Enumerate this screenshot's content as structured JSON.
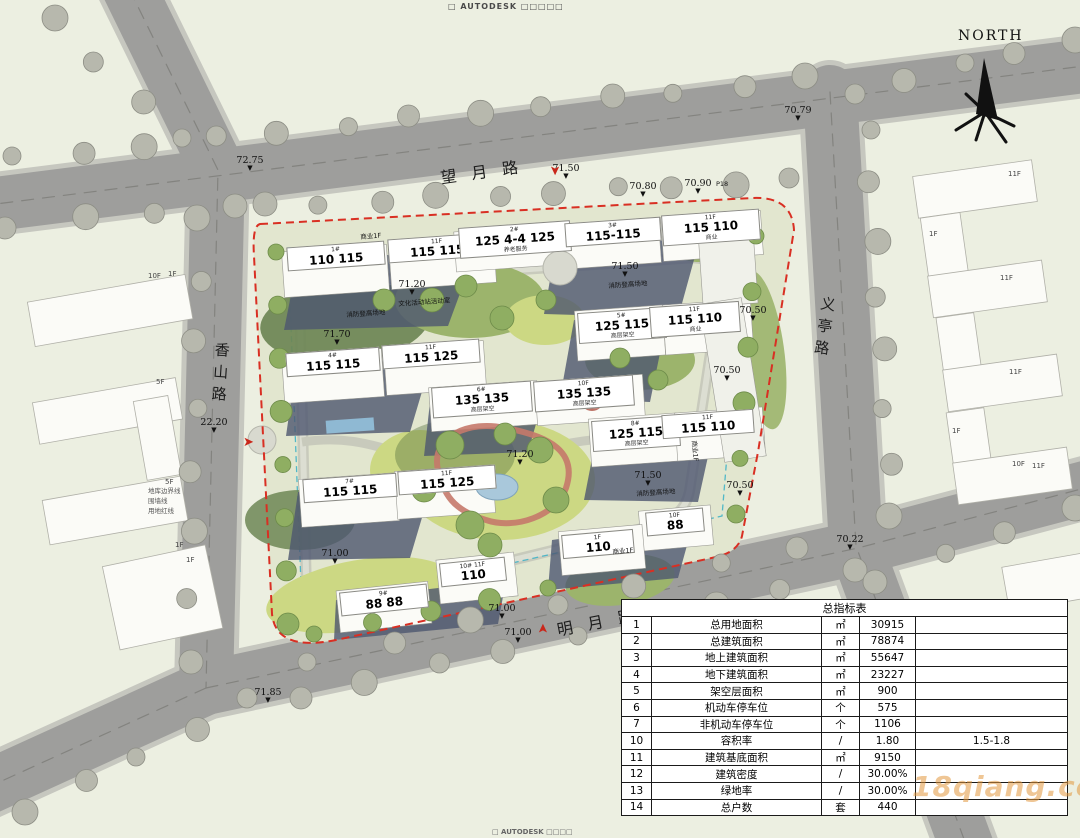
{
  "meta": {
    "autodesk_top": "□ AUTODESK □□□□□",
    "autodesk_bottom": "□ AUTODESK □□□□",
    "north": "NORTH",
    "watermark": "18qiang.com"
  },
  "roads": {
    "top": "望月路",
    "bottom": "明月路",
    "left": "香山路",
    "right": "义亭路"
  },
  "legend": [
    "地库边界线",
    "围墙线",
    "用地红线"
  ],
  "elevations": [
    {
      "t": "72.75",
      "x": 250,
      "y": 156
    },
    {
      "t": "70.79",
      "x": 798,
      "y": 106
    },
    {
      "t": "71.50",
      "x": 566,
      "y": 164
    },
    {
      "t": "70.80",
      "x": 643,
      "y": 182
    },
    {
      "t": "70.90",
      "x": 698,
      "y": 179
    },
    {
      "t": "22.20",
      "x": 214,
      "y": 418
    },
    {
      "t": "71.20",
      "x": 412,
      "y": 280
    },
    {
      "t": "71.70",
      "x": 337,
      "y": 330
    },
    {
      "t": "71.50",
      "x": 625,
      "y": 262
    },
    {
      "t": "70.50",
      "x": 753,
      "y": 306
    },
    {
      "t": "70.50",
      "x": 727,
      "y": 366
    },
    {
      "t": "71.20",
      "x": 520,
      "y": 450
    },
    {
      "t": "71.70",
      "x": 450,
      "y": 474
    },
    {
      "t": "71.50",
      "x": 648,
      "y": 471
    },
    {
      "t": "70.50",
      "x": 740,
      "y": 481
    },
    {
      "t": "71.00",
      "x": 335,
      "y": 549
    },
    {
      "t": "71.00",
      "x": 502,
      "y": 604
    },
    {
      "t": "71.00",
      "x": 518,
      "y": 628
    },
    {
      "t": "71.85",
      "x": 268,
      "y": 688
    },
    {
      "t": "70.22",
      "x": 850,
      "y": 535
    }
  ],
  "entrances": [
    {
      "x": 549,
      "y": 164,
      "r": 90
    },
    {
      "x": 243,
      "y": 436,
      "r": 0
    },
    {
      "x": 538,
      "y": 622,
      "r": -90
    }
  ],
  "buildings": [
    {
      "x": 287,
      "y": 244,
      "w": 98,
      "r": -4,
      "top": "1#",
      "big": "110  115",
      "sub": ""
    },
    {
      "x": 388,
      "y": 236,
      "w": 98,
      "r": -4,
      "top": "11F",
      "big": "115  115",
      "sub": ""
    },
    {
      "x": 459,
      "y": 224,
      "w": 112,
      "r": -4,
      "top": "2#",
      "big": "125  4-4  125",
      "sub": "养老服务"
    },
    {
      "x": 565,
      "y": 220,
      "w": 96,
      "r": -4,
      "top": "3#",
      "big": "115-115",
      "sub": ""
    },
    {
      "x": 662,
      "y": 212,
      "w": 98,
      "r": -4,
      "top": "11F",
      "big": "115  110",
      "sub": "商业"
    },
    {
      "x": 286,
      "y": 350,
      "w": 94,
      "r": -4,
      "top": "4#",
      "big": "115  115",
      "sub": ""
    },
    {
      "x": 382,
      "y": 342,
      "w": 98,
      "r": -4,
      "top": "11F",
      "big": "115  125",
      "sub": ""
    },
    {
      "x": 432,
      "y": 384,
      "w": 100,
      "r": -4,
      "top": "6#",
      "big": "135  135",
      "sub": "高层架空"
    },
    {
      "x": 534,
      "y": 378,
      "w": 100,
      "r": -4,
      "top": "10F",
      "big": "135  135",
      "sub": "高层架空"
    },
    {
      "x": 578,
      "y": 310,
      "w": 88,
      "r": -4,
      "top": "5#",
      "big": "125  115",
      "sub": "高层架空"
    },
    {
      "x": 650,
      "y": 304,
      "w": 90,
      "r": -4,
      "top": "11F",
      "big": "115  110",
      "sub": "商业"
    },
    {
      "x": 303,
      "y": 476,
      "w": 94,
      "r": -4,
      "top": "7#",
      "big": "115  115",
      "sub": ""
    },
    {
      "x": 398,
      "y": 468,
      "w": 98,
      "r": -4,
      "top": "11F",
      "big": "115  125",
      "sub": ""
    },
    {
      "x": 592,
      "y": 418,
      "w": 88,
      "r": -4,
      "top": "8#",
      "big": "125  115",
      "sub": "高层架空"
    },
    {
      "x": 662,
      "y": 412,
      "w": 92,
      "r": -4,
      "top": "11F",
      "big": "115  110",
      "sub": ""
    },
    {
      "x": 340,
      "y": 588,
      "w": 88,
      "r": -6,
      "top": "9#",
      "big": "88  88",
      "sub": ""
    },
    {
      "x": 440,
      "y": 560,
      "w": 66,
      "r": -6,
      "top": "10# 11F",
      "big": "110",
      "sub": ""
    },
    {
      "x": 646,
      "y": 510,
      "w": 58,
      "r": -5,
      "top": "10F",
      "big": "88",
      "sub": ""
    },
    {
      "x": 562,
      "y": 532,
      "w": 72,
      "r": -5,
      "top": "1F",
      "big": "110",
      "sub": ""
    }
  ],
  "notes": [
    {
      "t": "商业1F",
      "x": 360,
      "y": 231,
      "r": -4
    },
    {
      "t": "商业1F",
      "x": 700,
      "y": 440,
      "r": 85
    },
    {
      "t": "商业1F",
      "x": 612,
      "y": 546,
      "r": -5
    },
    {
      "t": "消防登高场地",
      "x": 346,
      "y": 309,
      "r": -4
    },
    {
      "t": "消防登高场地",
      "x": 608,
      "y": 280,
      "r": -4
    },
    {
      "t": "消防登高场地",
      "x": 636,
      "y": 488,
      "r": -4
    },
    {
      "t": "文化活动站活动室",
      "x": 398,
      "y": 298,
      "r": -4
    },
    {
      "t": "P18",
      "x": 716,
      "y": 180,
      "r": 0
    }
  ],
  "neighbors": [
    {
      "t": "10F",
      "x": 148,
      "y": 272
    },
    {
      "t": "1F",
      "x": 168,
      "y": 270
    },
    {
      "t": "5F",
      "x": 156,
      "y": 378
    },
    {
      "t": "5F",
      "x": 165,
      "y": 478
    },
    {
      "t": "1F",
      "x": 175,
      "y": 541
    },
    {
      "t": "1F",
      "x": 186,
      "y": 556
    },
    {
      "t": "11F",
      "x": 1008,
      "y": 170
    },
    {
      "t": "1F",
      "x": 929,
      "y": 230
    },
    {
      "t": "11F",
      "x": 1000,
      "y": 274
    },
    {
      "t": "11F",
      "x": 1009,
      "y": 368
    },
    {
      "t": "1F",
      "x": 952,
      "y": 427
    },
    {
      "t": "10F",
      "x": 1012,
      "y": 460
    },
    {
      "t": "11F",
      "x": 1032,
      "y": 462
    }
  ],
  "table": {
    "title": "总指标表",
    "rows": [
      {
        "no": "1",
        "name": "总用地面积",
        "unit": "㎡",
        "value": "30915",
        "remark": ""
      },
      {
        "no": "2",
        "name": "总建筑面积",
        "unit": "㎡",
        "value": "78874",
        "remark": ""
      },
      {
        "no": "3",
        "name": "地上建筑面积",
        "unit": "㎡",
        "value": "55647",
        "remark": ""
      },
      {
        "no": "4",
        "name": "地下建筑面积",
        "unit": "㎡",
        "value": "23227",
        "remark": ""
      },
      {
        "no": "5",
        "name": "架空层面积",
        "unit": "㎡",
        "value": "900",
        "remark": ""
      },
      {
        "no": "6",
        "name": "机动车停车位",
        "unit": "个",
        "value": "575",
        "remark": ""
      },
      {
        "no": "7",
        "name": "非机动车停车位",
        "unit": "个",
        "value": "1106",
        "remark": ""
      },
      {
        "no": "10",
        "name": "容积率",
        "unit": "/",
        "value": "1.80",
        "remark": "1.5-1.8"
      },
      {
        "no": "11",
        "name": "建筑基底面积",
        "unit": "㎡",
        "value": "9150",
        "remark": ""
      },
      {
        "no": "12",
        "name": "建筑密度",
        "unit": "/",
        "value": "30.00%",
        "remark": ""
      },
      {
        "no": "13",
        "name": "绿地率",
        "unit": "/",
        "value": "30.00%",
        "remark": ""
      },
      {
        "no": "14",
        "name": "总户数",
        "unit": "套",
        "value": "440",
        "remark": ""
      }
    ]
  }
}
